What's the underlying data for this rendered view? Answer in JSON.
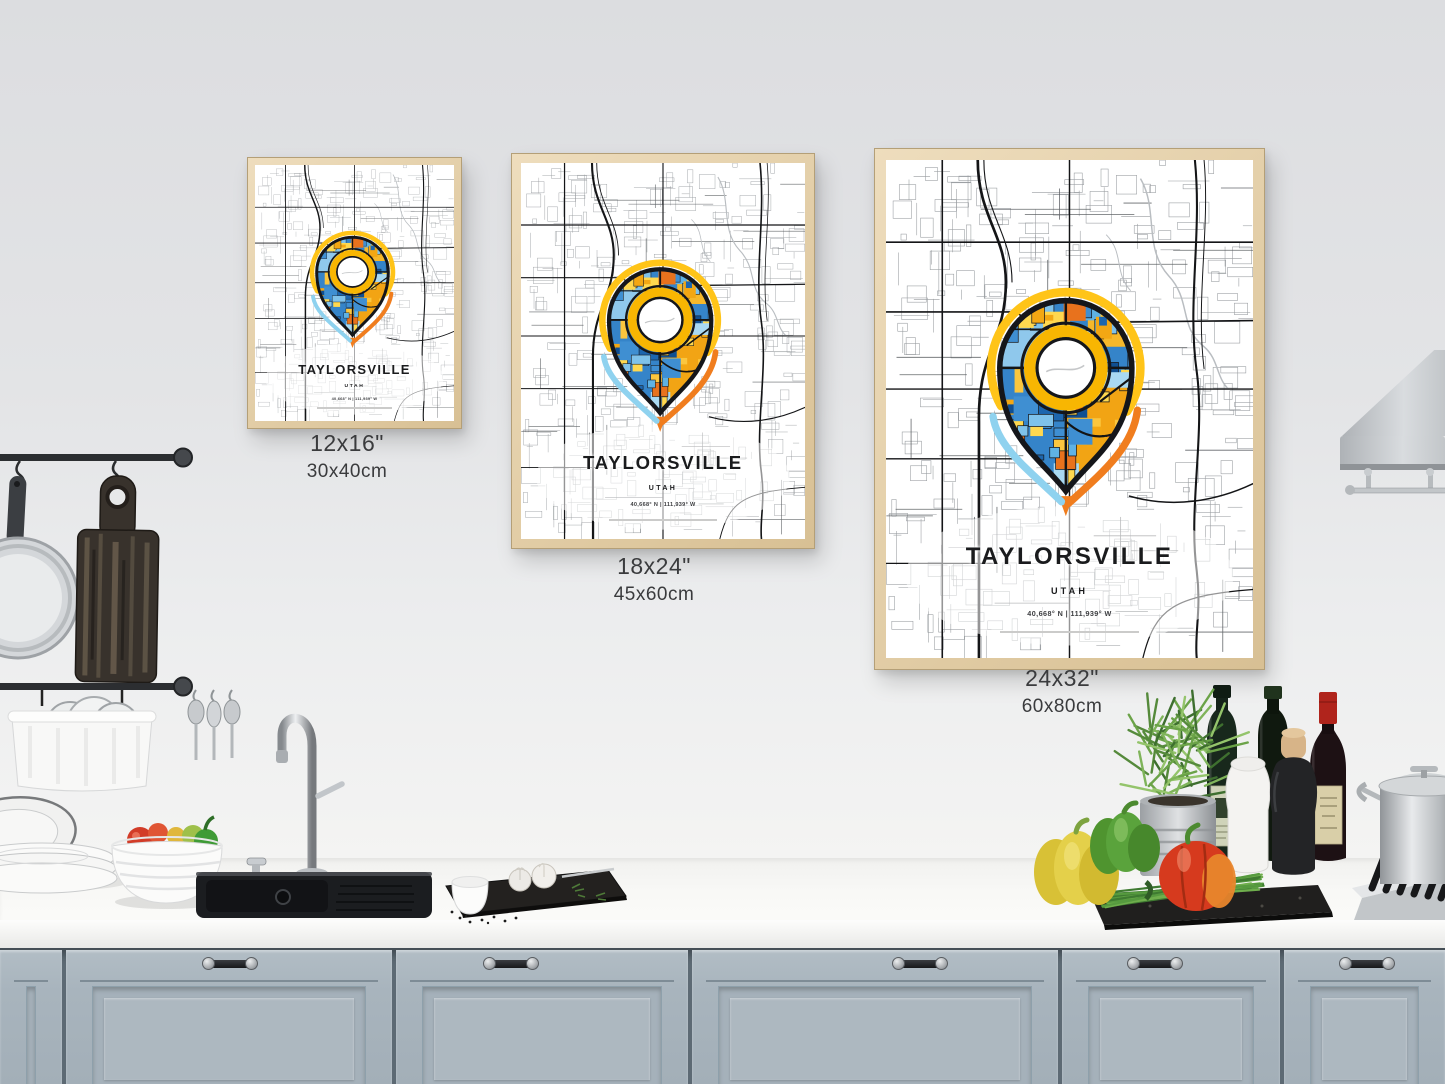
{
  "poster": {
    "title": "TAYLORSVILLE",
    "state": "UTAH",
    "coordinates": "40,668° N | 111,939° W"
  },
  "size_options": [
    {
      "inches": "12x16\"",
      "centimeters": "30x40cm"
    },
    {
      "inches": "18x24\"",
      "centimeters": "45x60cm"
    },
    {
      "inches": "24x32\"",
      "centimeters": "60x80cm"
    }
  ],
  "palette": {
    "wall": "#e4e5e7",
    "counter": "#f8f8f6",
    "cabinet": "#a8b4bd",
    "frame_wood": "#e2cda6",
    "map_road": "#141517",
    "pin_yellow": "#ffc418",
    "pin_orange": "#f07d1e",
    "pin_blue": "#2e7bc4",
    "pin_lightblue": "#8fd2ef",
    "ring_yellow": "#f8b602"
  }
}
